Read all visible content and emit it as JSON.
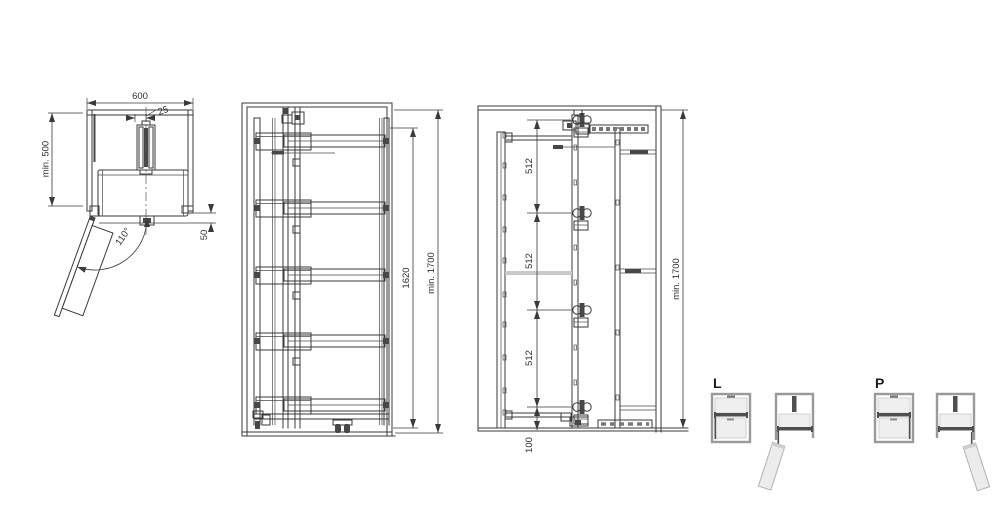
{
  "colors": {
    "background": "#ffffff",
    "line": "#3a3a3a",
    "icon_gray": "#9a9a9a",
    "icon_dark": "#4f4f4f",
    "icon_fill": "#efefef"
  },
  "top_view": {
    "width": "600",
    "rail_offset": "25",
    "depth": "min. 500",
    "door_angle": "110°",
    "front_gap": "50"
  },
  "front_view": {
    "frame_height": "1620",
    "cabinet_height": "min. 1700"
  },
  "side_view": {
    "hinge_spacing_top": "512",
    "hinge_spacing_middle": "512",
    "hinge_spacing_bottom": "512",
    "bottom_offset": "100",
    "cabinet_height": "min. 1700"
  },
  "door_variants": {
    "left_label": "L",
    "right_label": "P"
  }
}
